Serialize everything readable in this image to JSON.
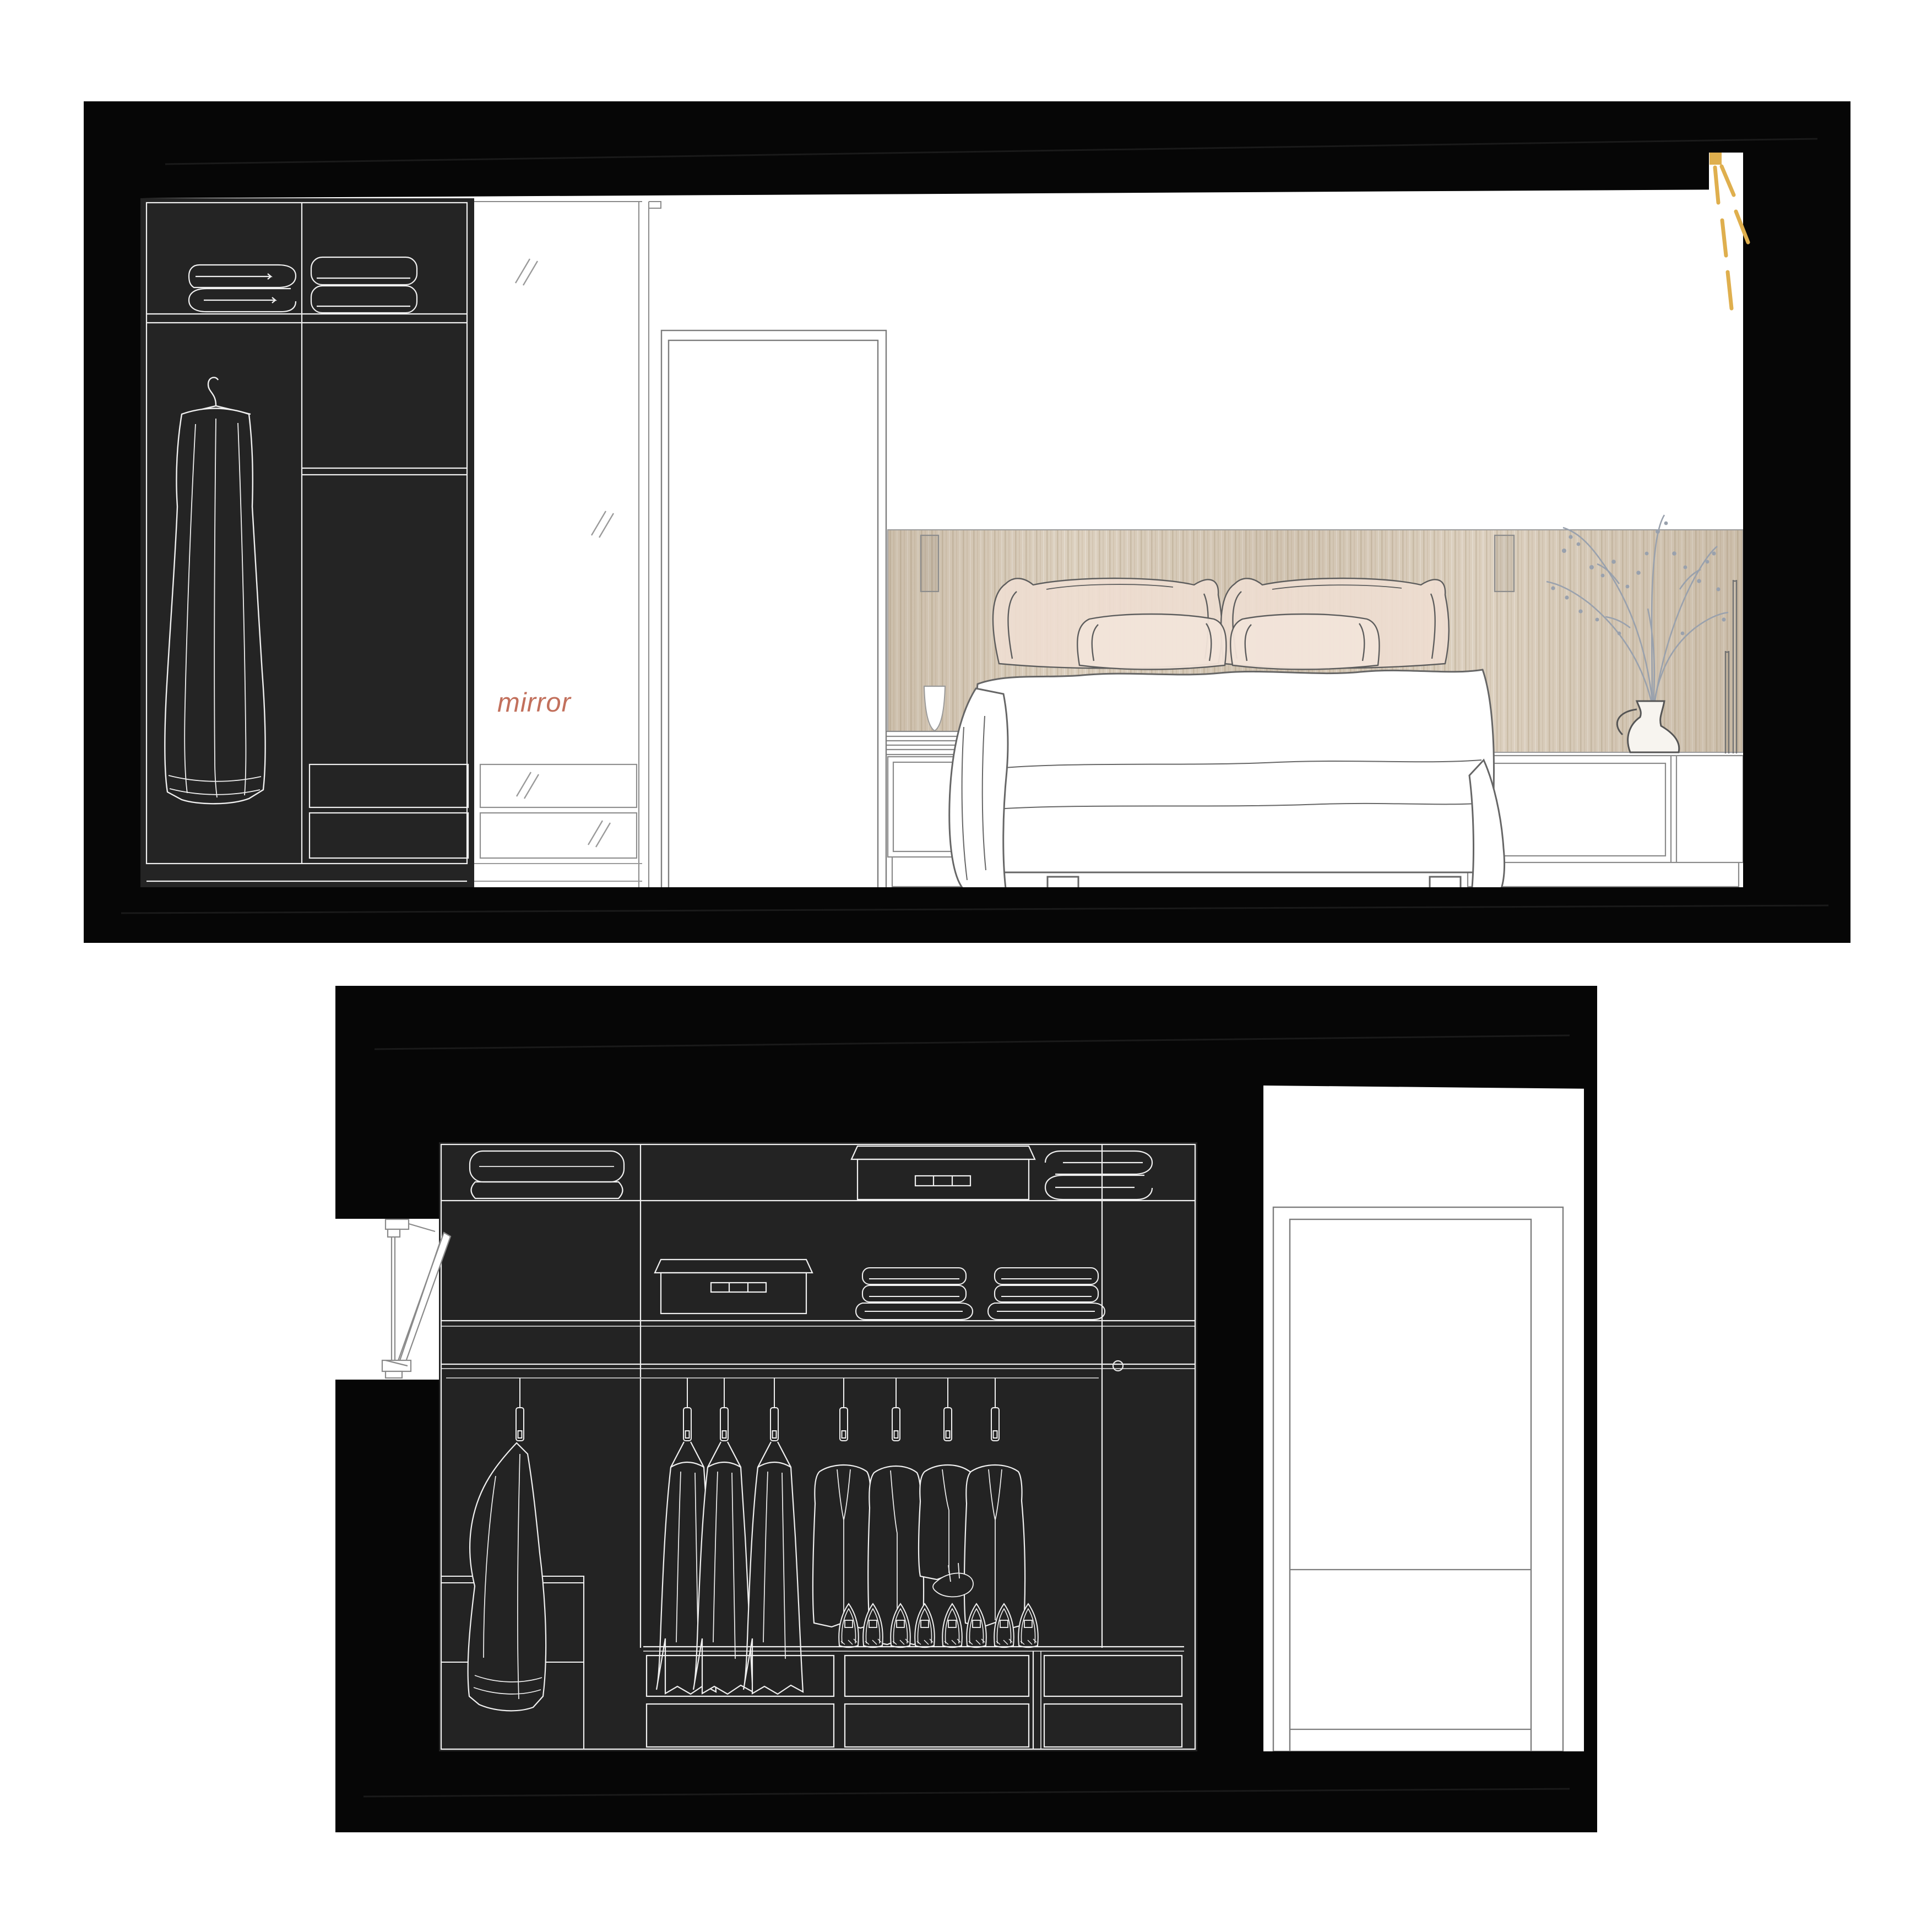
{
  "labels": {
    "mirror": "mirror"
  },
  "colors": {
    "frame_black": "#060606",
    "cabinet_dark": "#232323",
    "line_white": "#f0f0f0",
    "line_gray": "#7d7d7d",
    "wood_base": "#dcd0bf",
    "wood_grain": "#9a8565",
    "accent_text": "#c2705c",
    "gold": "#dfaf4e",
    "branch_gray": "#99a1ad",
    "pillow_fill": "#eeded2"
  },
  "bedroom_panel": {
    "name": "bedroom wall elevation",
    "light_ray_count": 5,
    "wardrobe": {
      "towel_stacks": 2,
      "hanging_garments": 1,
      "dark_drawers": 2
    },
    "mirror_column": {
      "drawers": 2,
      "glass_hatches": 4
    },
    "door_count": 1,
    "headboard_niches": 2,
    "bed_pillows": 4,
    "nightstand_items": [
      "water glass"
    ],
    "sideboard_items": [
      "vase with branches",
      "light rod",
      "light rod"
    ]
  },
  "closet_panel": {
    "name": "walk-in closet elevation",
    "shelf_row1": [
      "folded blanket",
      "storage box",
      "folded towel"
    ],
    "shelf_row2": [
      "storage box",
      "towel stack",
      "towel stack"
    ],
    "hanging_garment_count": 8,
    "shoe_count": 8,
    "drawer_units": 3,
    "drawer_rows": 2,
    "door_count": 1,
    "knob_count": 1,
    "wall_item": "tilted mirror side view"
  }
}
